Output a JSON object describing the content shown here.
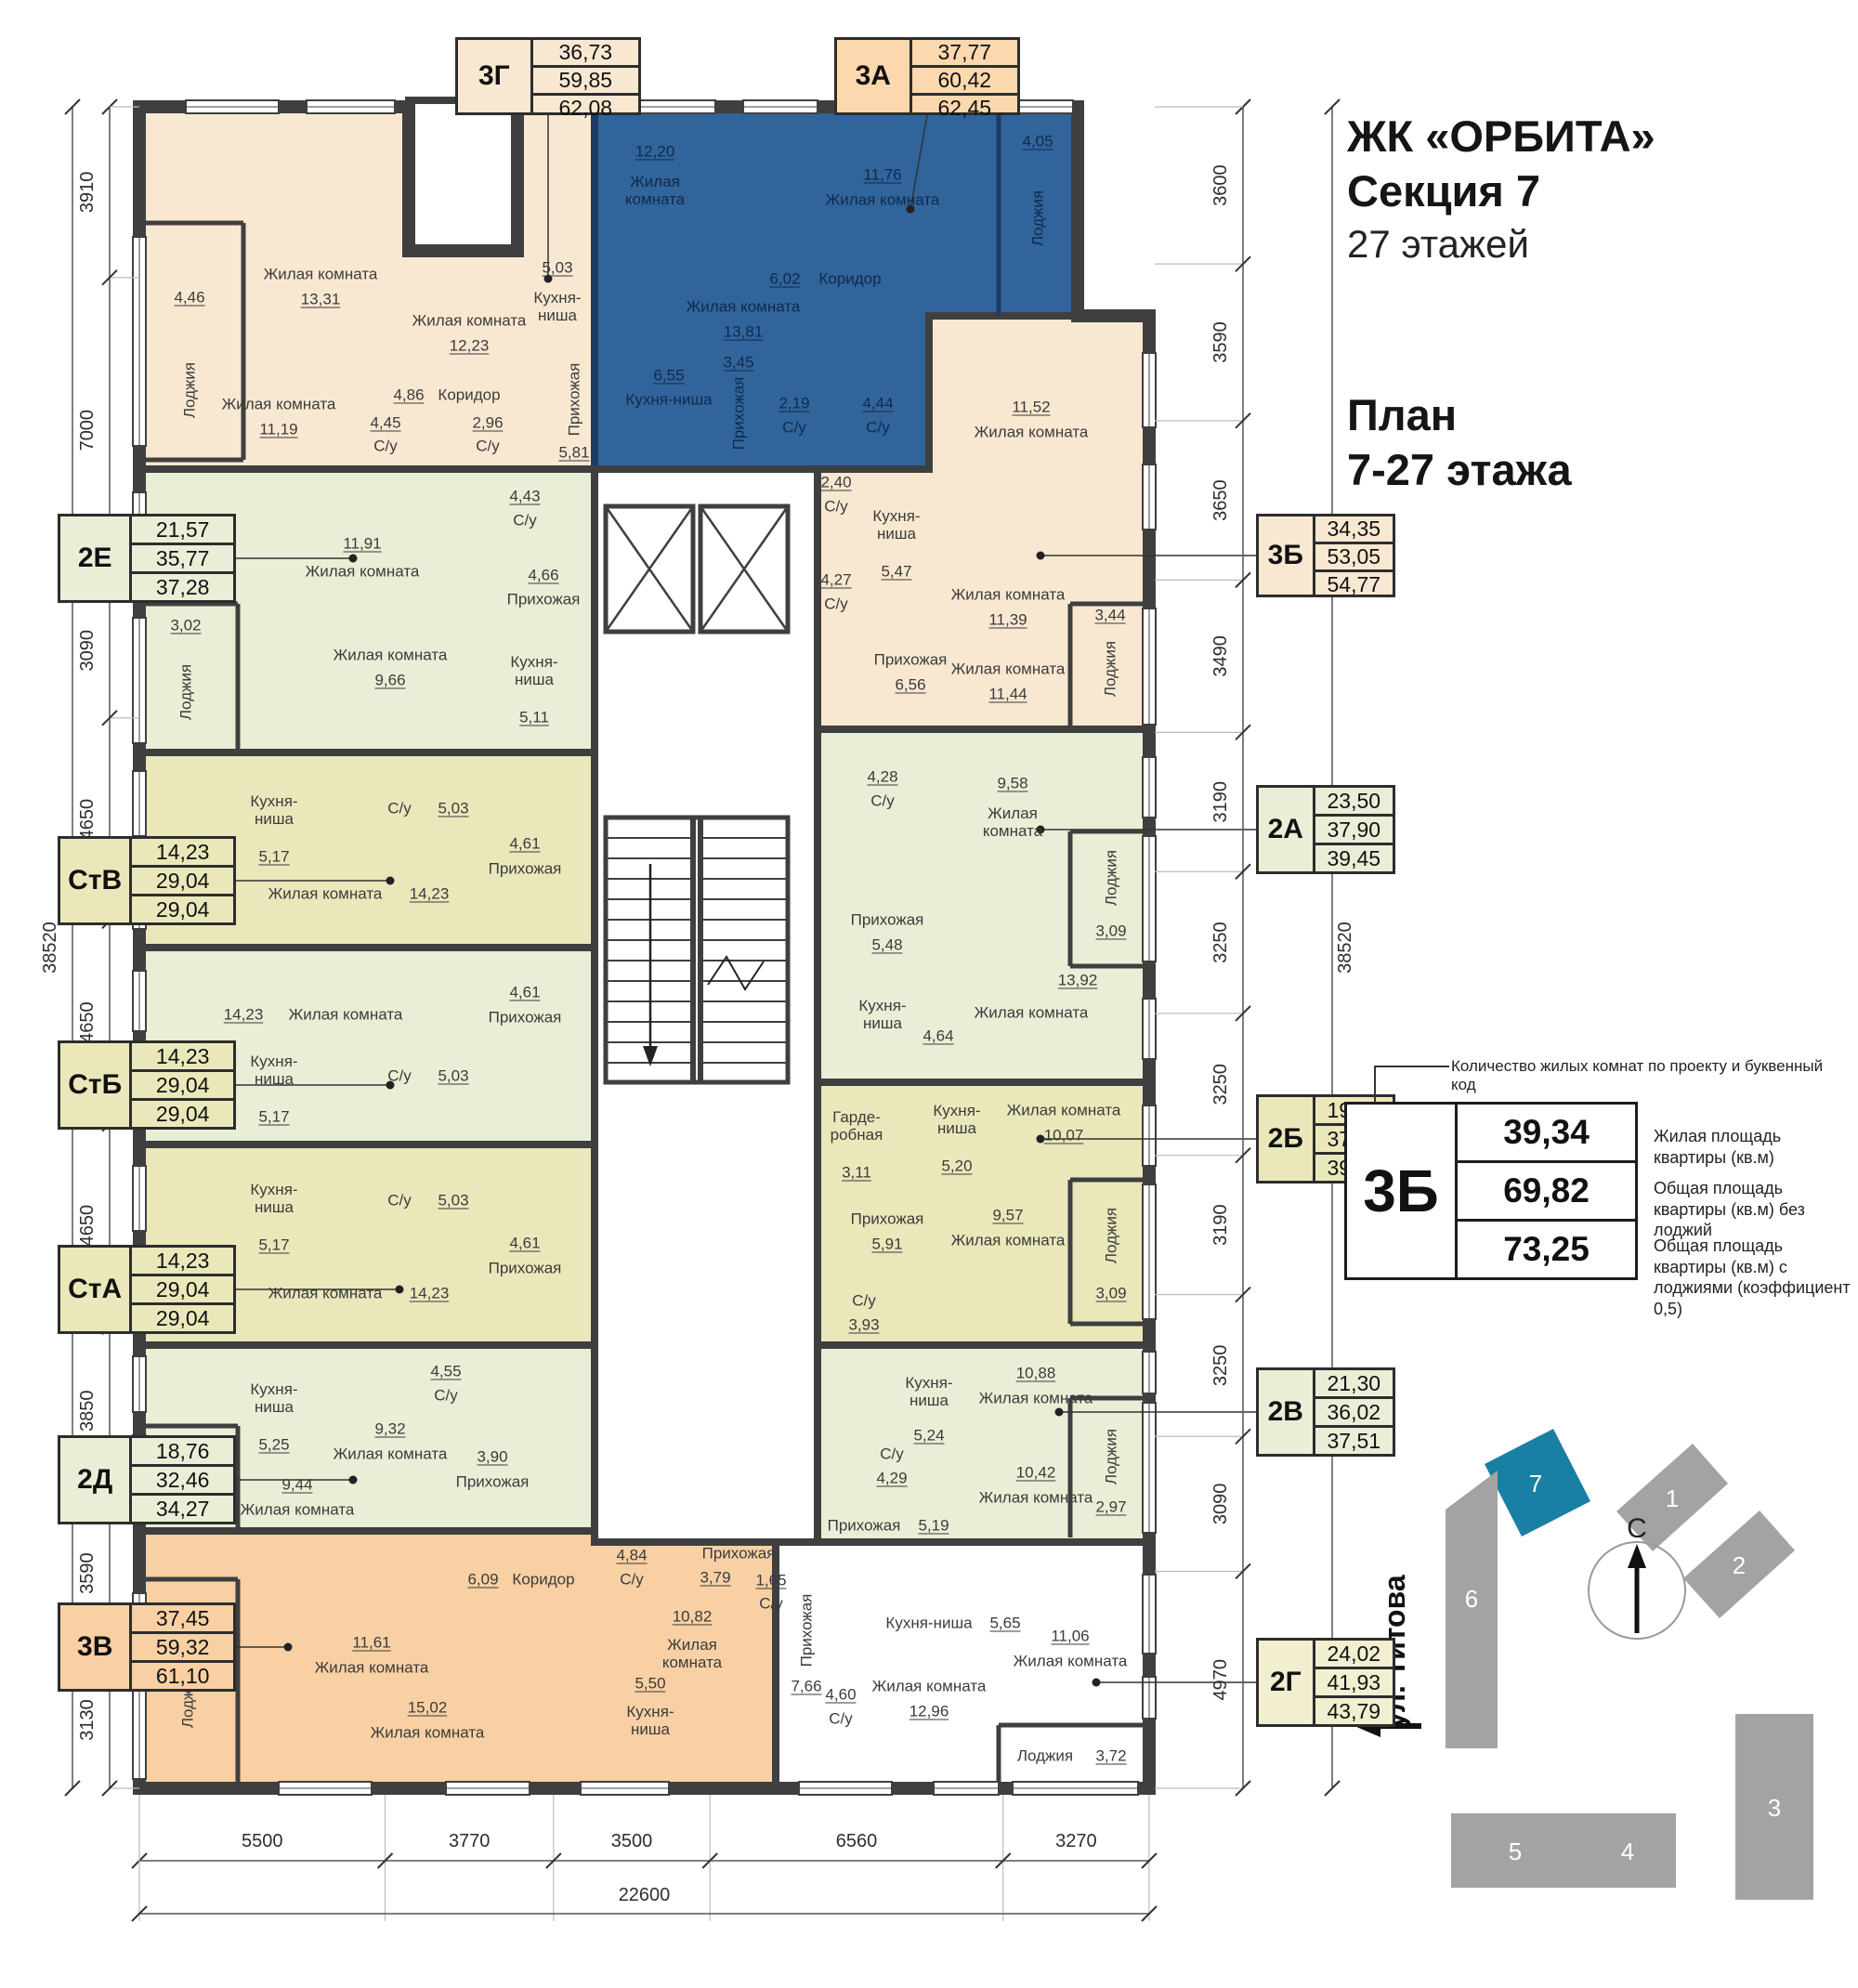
{
  "header": {
    "complex": "ЖК «ОРБИТА»",
    "section": "Секция 7",
    "floors": "27 этажей",
    "plan_line1": "План",
    "plan_line2": "7-27 этажа"
  },
  "legend": {
    "note": "Количество жилых комнат по проекту и буквенный код",
    "code": "3Б",
    "rows": [
      {
        "value": "39,34",
        "caption": "Жилая площадь квартиры (кв.м)"
      },
      {
        "value": "69,82",
        "caption": "Общая площадь квартиры (кв.м) без лоджий"
      },
      {
        "value": "73,25",
        "caption": "Общая площадь квартиры (кв.м) с лоджиями (коэффициент 0,5)"
      }
    ]
  },
  "site_plan": {
    "street": "ул. Титова",
    "north": "С",
    "highlighted_building": "7",
    "buildings": [
      "1",
      "2",
      "3",
      "4",
      "5",
      "6",
      "7"
    ]
  },
  "dimensions": {
    "left": [
      "3910",
      "7000",
      "3090",
      "4650",
      "4650",
      "4650",
      "3850",
      "3590",
      "3130"
    ],
    "left_total": "38520",
    "right": [
      "3600",
      "3590",
      "3650",
      "3490",
      "3190",
      "3250",
      "3250",
      "3190",
      "3250",
      "3090",
      "4970"
    ],
    "right_total": "38520",
    "bottom": [
      "5500",
      "3770",
      "3500",
      "6560",
      "3270"
    ],
    "bottom_total": "22600"
  },
  "colors": {
    "wall": "#3f3f40",
    "blue_wall": "#1c3c63",
    "blue_fill": "#31649b",
    "cream": "#f9e8d1",
    "peach": "#fbd8ae",
    "green": "#e9efd6",
    "olive": "#eae8ba",
    "orange": "#f8d0a4",
    "paleyellow": "#f1efcf",
    "map_teal": "#1a7fa4",
    "map_gray": "#a3a3a3"
  },
  "apartments": [
    {
      "code": "3Г",
      "box_color": "cream",
      "values": [
        "36,73",
        "59,85",
        "62,08"
      ],
      "rooms": [
        {
          "name": "Жилая комната",
          "area": "13,31"
        },
        {
          "name": "Жилая комната",
          "area": "12,23"
        },
        {
          "name": "Кухня-ниша",
          "area": "5,03"
        },
        {
          "name": "Коридор",
          "area": "4,86"
        },
        {
          "name": "Жилая комната",
          "area": "11,19"
        },
        {
          "name": "С/у",
          "area": "4,45"
        },
        {
          "name": "С/у",
          "area": "2,96"
        },
        {
          "name": "Прихожая",
          "area": "5,81"
        },
        {
          "name": "Лоджия",
          "area": "4,46"
        }
      ]
    },
    {
      "code": "3А",
      "box_color": "peach",
      "values": [
        "37,77",
        "60,42",
        "62,45"
      ],
      "rooms": [
        {
          "name": "Жилая комната",
          "area": "12,20"
        },
        {
          "name": "Жилая комната",
          "area": "13,81"
        },
        {
          "name": "Жилая комната",
          "area": "11,76"
        },
        {
          "name": "Лоджия",
          "area": "4,05"
        },
        {
          "name": "Кухня-ниша",
          "area": "6,55"
        },
        {
          "name": "Коридор",
          "area": "6,02"
        },
        {
          "name": "Прихожая",
          "area": "3,45"
        },
        {
          "name": "С/у",
          "area": "2,19"
        },
        {
          "name": "С/у",
          "area": "4,44"
        }
      ]
    },
    {
      "code": "3Б",
      "box_color": "cream",
      "values": [
        "34,35",
        "53,05",
        "54,77"
      ],
      "rooms": [
        {
          "name": "Жилая комната",
          "area": "11,52"
        },
        {
          "name": "Кухня-ниша",
          "area": "5,47"
        },
        {
          "name": "Жилая комната",
          "area": "11,39"
        },
        {
          "name": "С/у",
          "area": "2,40"
        },
        {
          "name": "Прихожая",
          "area": "6,56"
        },
        {
          "name": "Жилая комната",
          "area": "11,44"
        },
        {
          "name": "С/у",
          "area": "4,27"
        },
        {
          "name": "Лоджия",
          "area": "3,44"
        }
      ]
    },
    {
      "code": "2Е",
      "box_color": "green",
      "values": [
        "21,57",
        "35,77",
        "37,28"
      ],
      "rooms": [
        {
          "name": "Жилая комната",
          "area": "11,91"
        },
        {
          "name": "С/у",
          "area": "4,43"
        },
        {
          "name": "Прихожая",
          "area": "4,66"
        },
        {
          "name": "Лоджия",
          "area": "3,02"
        },
        {
          "name": "Жилая комната",
          "area": "9,66"
        },
        {
          "name": "Кухня-ниша",
          "area": "5,11"
        }
      ]
    },
    {
      "code": "СтВ",
      "box_color": "olive",
      "values": [
        "14,23",
        "29,04",
        "29,04"
      ],
      "rooms": [
        {
          "name": "Кухня-ниша",
          "area": "5,17"
        },
        {
          "name": "С/у",
          "area": "5,03"
        },
        {
          "name": "Жилая комната",
          "area": "14,23"
        },
        {
          "name": "Прихожая",
          "area": "4,61"
        }
      ]
    },
    {
      "code": "СтБ",
      "box_color": "olive",
      "values": [
        "14,23",
        "29,04",
        "29,04"
      ],
      "rooms": [
        {
          "name": "Жилая комната",
          "area": "14,23"
        },
        {
          "name": "Прихожая",
          "area": "4,61"
        },
        {
          "name": "Кухня-ниша",
          "area": "5,17"
        },
        {
          "name": "С/у",
          "area": "5,03"
        }
      ]
    },
    {
      "code": "СтА",
      "box_color": "olive",
      "values": [
        "14,23",
        "29,04",
        "29,04"
      ],
      "rooms": [
        {
          "name": "Кухня-ниша",
          "area": "5,17"
        },
        {
          "name": "С/у",
          "area": "5,03"
        },
        {
          "name": "Жилая комната",
          "area": "14,23"
        },
        {
          "name": "Прихожая",
          "area": "4,61"
        }
      ]
    },
    {
      "code": "2Д",
      "box_color": "green",
      "values": [
        "18,76",
        "32,46",
        "34,27"
      ],
      "rooms": [
        {
          "name": "Кухня-ниша",
          "area": "5,25"
        },
        {
          "name": "С/у",
          "area": "4,55"
        },
        {
          "name": "Жилая комната",
          "area": "9,32"
        },
        {
          "name": "Прихожая",
          "area": "3,90"
        },
        {
          "name": "Жилая комната",
          "area": "9,44"
        },
        {
          "name": "Лоджия",
          "area": "3,62"
        }
      ]
    },
    {
      "code": "3В",
      "box_color": "orange",
      "values": [
        "37,45",
        "59,32",
        "61,10"
      ],
      "rooms": [
        {
          "name": "Лоджия",
          "area": "3,55"
        },
        {
          "name": "Жилая комната",
          "area": "11,61"
        },
        {
          "name": "Жилая комната",
          "area": "10,82"
        },
        {
          "name": "С/у",
          "area": "4,84"
        },
        {
          "name": "Коридор",
          "area": "6,09"
        },
        {
          "name": "Прихожая",
          "area": "3,79"
        },
        {
          "name": "С/у",
          "area": "1,65"
        },
        {
          "name": "Кухня-ниша",
          "area": "5,50"
        },
        {
          "name": "Жилая комната",
          "area": "15,02"
        }
      ]
    },
    {
      "code": "2А",
      "box_color": "green",
      "values": [
        "23,50",
        "37,90",
        "39,45"
      ],
      "rooms": [
        {
          "name": "С/у",
          "area": "4,28"
        },
        {
          "name": "Жилая комната",
          "area": "9,58"
        },
        {
          "name": "Лоджия",
          "area": "3,09"
        },
        {
          "name": "Прихожая",
          "area": "5,48"
        },
        {
          "name": "Кухня-ниша",
          "area": "4,64"
        },
        {
          "name": "Жилая комната",
          "area": "13,92"
        }
      ]
    },
    {
      "code": "2Б",
      "box_color": "olive",
      "values": [
        "19,64",
        "37,79",
        "39,34"
      ],
      "rooms": [
        {
          "name": "Гарде-робная",
          "area": "3,11"
        },
        {
          "name": "Кухня-ниша",
          "area": "5,20"
        },
        {
          "name": "Жилая комната",
          "area": "10,07"
        },
        {
          "name": "Прихожая",
          "area": "5,91"
        },
        {
          "name": "Жилая комната",
          "area": "9,57"
        },
        {
          "name": "С/у",
          "area": "3,93"
        },
        {
          "name": "Лоджия",
          "area": "3,09"
        }
      ]
    },
    {
      "code": "2В",
      "box_color": "green",
      "values": [
        "21,30",
        "36,02",
        "37,51"
      ],
      "rooms": [
        {
          "name": "С/у",
          "area": "4,29"
        },
        {
          "name": "Жилая комната",
          "area": "10,88"
        },
        {
          "name": "Прихожая",
          "area": "5,19"
        },
        {
          "name": "Жилая комната",
          "area": "10,42"
        },
        {
          "name": "Кухня-ниша",
          "area": "5,24"
        },
        {
          "name": "Лоджия",
          "area": "2,97"
        }
      ]
    },
    {
      "code": "2Г",
      "box_color": "paleyellow",
      "values": [
        "24,02",
        "41,93",
        "43,79"
      ],
      "rooms": [
        {
          "name": "Прихожая",
          "area": "7,66"
        },
        {
          "name": "Кухня-ниша",
          "area": "5,65"
        },
        {
          "name": "Жилая комната",
          "area": "12,96"
        },
        {
          "name": "Жилая комната",
          "area": "11,06"
        },
        {
          "name": "С/у",
          "area": "4,60"
        },
        {
          "name": "Лоджия",
          "area": "3,72"
        }
      ]
    }
  ]
}
